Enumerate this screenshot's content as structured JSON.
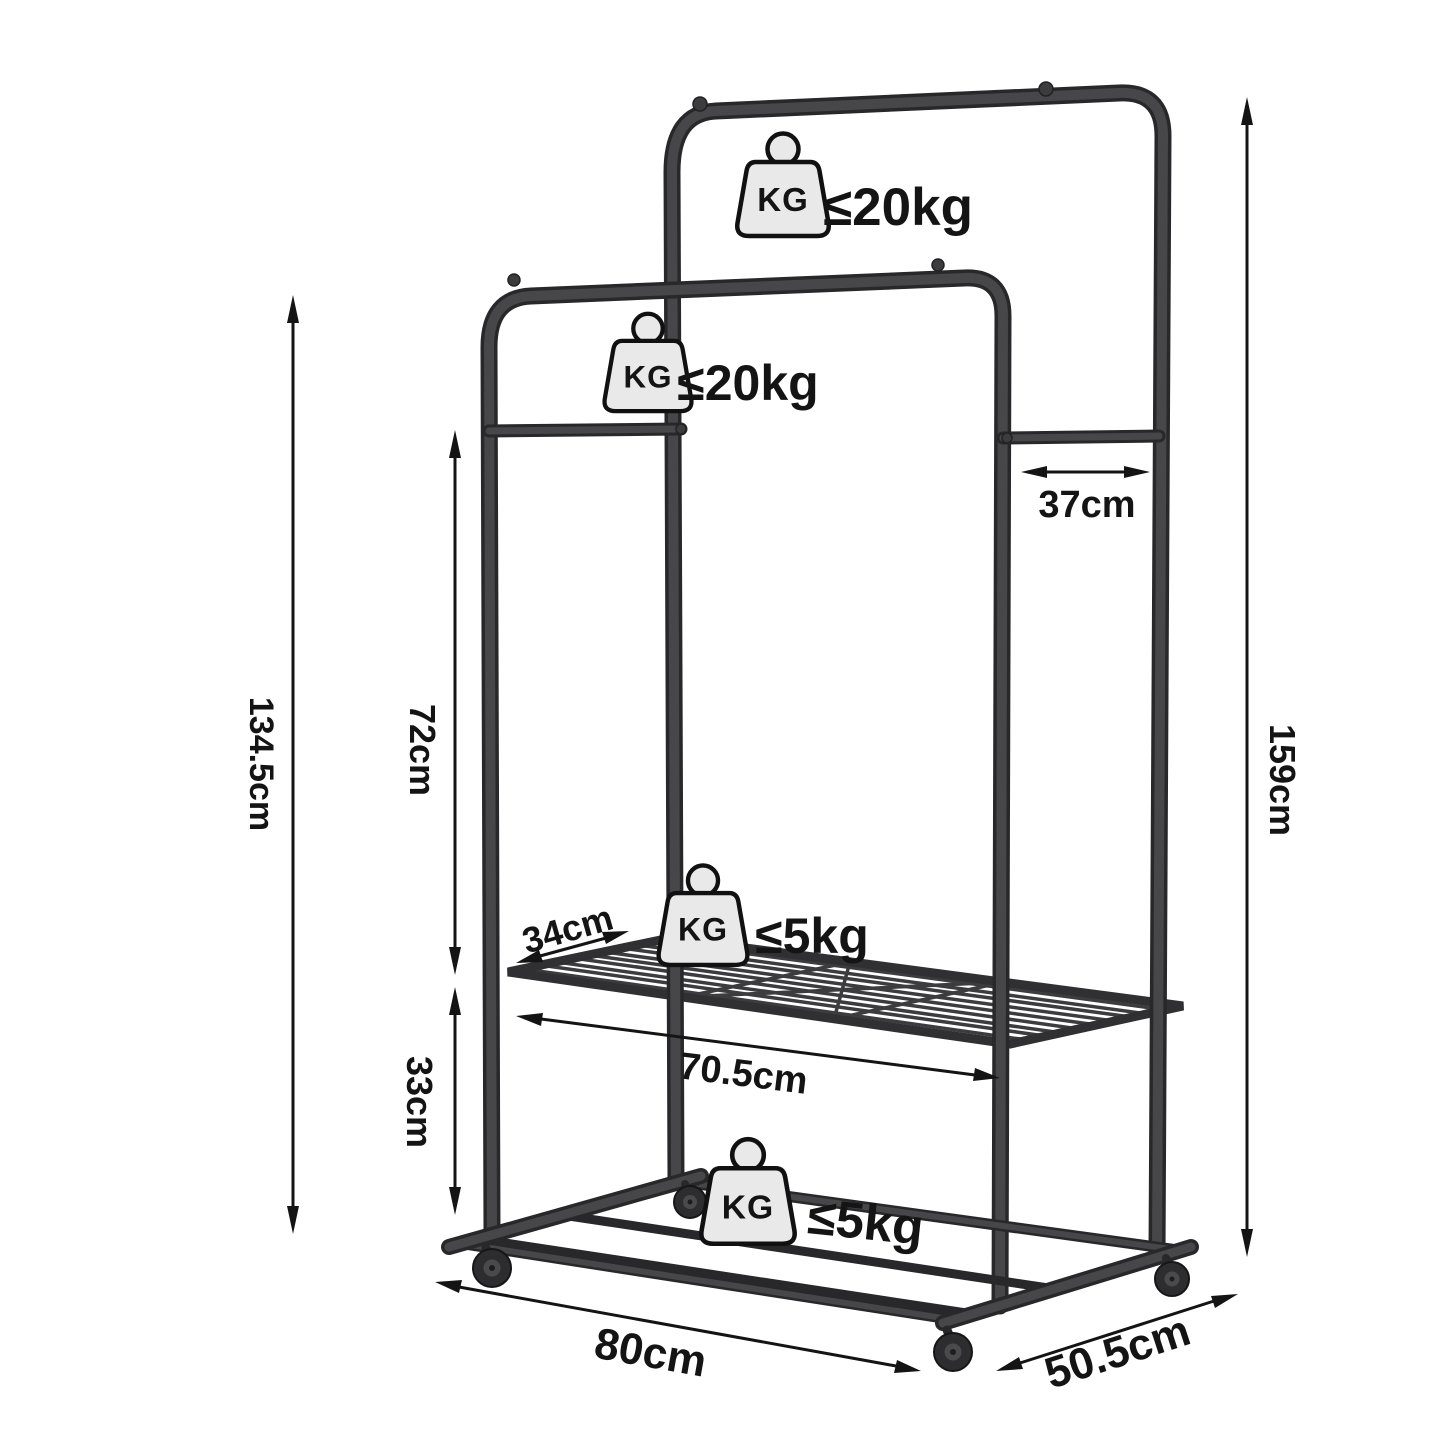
{
  "colors": {
    "annotation": "#141414",
    "metal-dark": "#28282a",
    "metal": "#47474a",
    "icon-fill": "#e9e9e9",
    "bg": "#ffffff"
  },
  "dims": {
    "h_front": "134.5cm",
    "h_back": "159cm",
    "rail_to_shelf": "72cm",
    "shelf_to_base": "33cm",
    "top_depth": "37cm",
    "shelf_depth": "34cm",
    "shelf_width": "70.5cm",
    "base_width": "80cm",
    "base_depth": "50.5cm"
  },
  "cap": {
    "kg": "KG",
    "top_rail": "≤20kg",
    "lower_rail": "≤20kg",
    "middle_shelf": "≤5kg",
    "bottom_shelf": "≤5kg"
  }
}
